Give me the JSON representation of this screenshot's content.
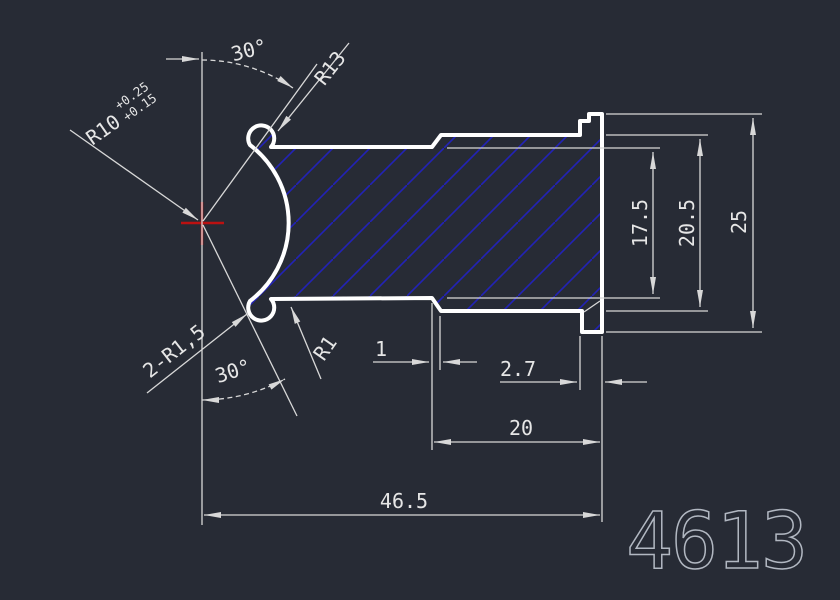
{
  "drawing_number": "4613",
  "labels": {
    "angle_top": "30°",
    "angle_bottom": "30°",
    "r13": "R13",
    "r10": "R10",
    "r10_tol_upper": "+0.25",
    "r10_tol_lower": "+0.15",
    "fillets": "2-R1,5",
    "r1": "R1"
  },
  "dims": {
    "chamfer_width": "1",
    "flange_thickness": "2.7",
    "step_length": "20",
    "total_length": "46.5",
    "dia_small": "17.5",
    "dia_mid": "20.5",
    "dia_flange": "25"
  },
  "colors": {
    "bg": "#272b35",
    "outline": "#ffffff",
    "dim": "#d8d8d8",
    "text": "#e6e6e6",
    "hatch": "#2222b8",
    "center": "#bb1111",
    "partnum": "#b2b8c2"
  }
}
